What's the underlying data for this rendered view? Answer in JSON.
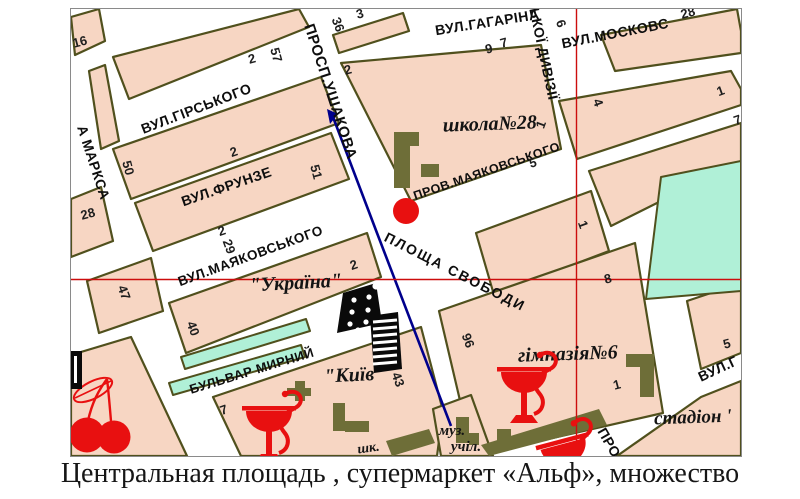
{
  "caption": "Центральная площадь , супермаркет «Альф», множество",
  "map": {
    "colors": {
      "block_fill": "#f7d6c3",
      "block_stroke": "#50501d",
      "green_fill": "#b0f0d7",
      "building_fill": "#6e6e38",
      "route_blue": "#00008c",
      "marker_red": "#e81010",
      "crosshair_red": "#cc0d0d",
      "icon_black": "#0a0a0a",
      "pharmacy_red": "#e81010"
    },
    "crosshair": {
      "x": 505.5,
      "y": 270.5
    },
    "marker": {
      "x": 335,
      "y": 202,
      "r": 13
    },
    "route": {
      "points": "262,108 306,224 380,417",
      "arrow": "256,100 267,105 259,115"
    },
    "blocks": [
      {
        "name": "block-16",
        "points": "0,8 28,0 34,32 4,46"
      },
      {
        "name": "block-topleft",
        "points": "42,48 228,0 238,18 58,90"
      },
      {
        "name": "block-marksa-sliver",
        "points": "18,62 34,56 48,132 30,140"
      },
      {
        "name": "block-28",
        "points": "0,190 30,178 42,232 0,248"
      },
      {
        "name": "block-50",
        "points": "42,140 250,68 268,114 60,190"
      },
      {
        "name": "block-51",
        "points": "64,194 260,124 278,170 82,242"
      },
      {
        "name": "block-47",
        "points": "16,272 80,249 92,302 28,324"
      },
      {
        "name": "block-ukraina",
        "points": "98,294 296,224 310,268 115,344"
      },
      {
        "name": "block-kyiv",
        "points": "142,388 350,318 372,402 366,447 170,447"
      },
      {
        "name": "block-bottomleft",
        "points": "0,346 60,328 116,447 0,447"
      },
      {
        "name": "block-shkola",
        "points": "270,54 470,36 490,140 340,192"
      },
      {
        "name": "block-36",
        "points": "262,26 332,4 338,22 268,44"
      },
      {
        "name": "block-topright-28",
        "points": "530,26 666,0 670,22 670,44 544,62"
      },
      {
        "name": "block-4",
        "points": "488,92 660,62 670,80 670,96 506,150"
      },
      {
        "name": "block-1-east",
        "points": "518,162 670,114 670,152 540,217"
      },
      {
        "name": "block-center-1",
        "points": "405,224 520,182 538,242 423,286"
      },
      {
        "name": "block-gimnasia",
        "points": "368,302 564,234 592,404 402,447"
      },
      {
        "name": "block-5",
        "points": "616,292 670,274 670,344 630,360"
      },
      {
        "name": "block-stadion",
        "points": "546,447 630,388 670,372 670,447"
      },
      {
        "name": "block-muz",
        "points": "362,400 400,386 422,447 370,447"
      }
    ],
    "green_areas": [
      {
        "name": "green-block-east",
        "points": "590,168 670,152 670,282 575,290"
      },
      {
        "name": "green-strip-1",
        "points": "110,348 235,310 239,322 114,360"
      },
      {
        "name": "green-strip-2",
        "points": "98,374 230,336 234,348 102,386"
      }
    ],
    "buildings": [
      {
        "x": 323,
        "y": 123,
        "w": 16,
        "h": 56
      },
      {
        "x": 339,
        "y": 123,
        "w": 9,
        "h": 14
      },
      {
        "x": 350,
        "y": 155,
        "w": 18,
        "h": 13
      },
      {
        "x": 555,
        "y": 345,
        "w": 28,
        "h": 13
      },
      {
        "x": 569,
        "y": 358,
        "w": 14,
        "h": 30
      },
      {
        "x": 426,
        "y": 420,
        "w": 14,
        "h": 14
      },
      {
        "x": 385,
        "y": 408,
        "w": 13,
        "h": 26
      },
      {
        "x": 398,
        "y": 424,
        "w": 10,
        "h": 12
      },
      {
        "x": 224,
        "y": 372,
        "w": 10,
        "h": 20
      },
      {
        "x": 216,
        "y": 379,
        "w": 24,
        "h": 8
      },
      {
        "x": 262,
        "y": 394,
        "w": 12,
        "h": 28
      },
      {
        "x": 274,
        "y": 412,
        "w": 24,
        "h": 11
      }
    ],
    "building_polys": [
      {
        "points": "410,436 528,400 536,416 418,447"
      },
      {
        "points": "315,432 358,420 364,434 321,447"
      }
    ],
    "street_labels": [
      {
        "text": "ПРОСП.УШАКОВА",
        "x": 255,
        "y": 84,
        "rot": 72,
        "size": 15
      },
      {
        "text": "ВУЛ.ГАГАРІНА",
        "x": 417,
        "y": 18,
        "rot": -9,
        "size": 14
      },
      {
        "text": "ВУЛ.МОСКОВС",
        "x": 545,
        "y": 29,
        "rot": -11,
        "size": 14
      },
      {
        "text": "ЬКОЇ ДИВІЗІЇ",
        "x": 468,
        "y": 46,
        "rot": 78,
        "size": 14
      },
      {
        "text": "ВУЛ.ГІРСЬКОГО",
        "x": 127,
        "y": 104,
        "rot": -21,
        "size": 14
      },
      {
        "text": "ВУЛ.ФРУНЗЕ",
        "x": 157,
        "y": 182,
        "rot": -19,
        "size": 14
      },
      {
        "text": "ВУЛ.МАЯКОВСЬКОГО",
        "x": 181,
        "y": 251,
        "rot": -20,
        "size": 13.5
      },
      {
        "text": "ПРОВ.МАЯКОВСЬКОГО",
        "x": 417,
        "y": 166,
        "rot": -19,
        "size": 12.5
      },
      {
        "text": "ПЛОЩА СВОБОДИ",
        "x": 382,
        "y": 267,
        "rot": 27,
        "size": 14,
        "ls": 2
      },
      {
        "text": "БУЛЬВАР МИРНИЙ",
        "x": 182,
        "y": 366,
        "rot": -17,
        "size": 13
      },
      {
        "text": "А МАРКСА",
        "x": 18,
        "y": 155,
        "rot": 72,
        "size": 14
      },
      {
        "text": "ВУЛ.Г",
        "x": 649,
        "y": 364,
        "rot": -25,
        "size": 14
      },
      {
        "text": "ПРО",
        "x": 534,
        "y": 436,
        "rot": 60,
        "size": 14
      }
    ],
    "place_labels": [
      {
        "text": "школа№28",
        "x": 419,
        "y": 121,
        "rot": -2,
        "size": 20
      },
      {
        "text": "гімназія№6",
        "x": 497,
        "y": 351,
        "rot": -2,
        "size": 20
      },
      {
        "text": "\"Україна\"",
        "x": 225,
        "y": 280,
        "rot": -3,
        "size": 20
      },
      {
        "text": "\"Київ\"",
        "x": 284,
        "y": 372,
        "rot": -3,
        "size": 20
      },
      {
        "text": "стадіон '",
        "x": 622,
        "y": 414,
        "rot": -2,
        "size": 19
      },
      {
        "text": "муз.",
        "x": 381,
        "y": 426,
        "rot": 0,
        "size": 15
      },
      {
        "text": "учіл.",
        "x": 395,
        "y": 442,
        "rot": 0,
        "size": 15
      },
      {
        "text": "шк.",
        "x": 298,
        "y": 443,
        "rot": -8,
        "size": 14
      }
    ],
    "numbers": [
      {
        "text": "16",
        "x": 10,
        "y": 37,
        "rot": -15
      },
      {
        "text": "2",
        "x": 182,
        "y": 54,
        "rot": -15
      },
      {
        "text": "57",
        "x": 201,
        "y": 47,
        "rot": 75
      },
      {
        "text": "36",
        "x": 263,
        "y": 17,
        "rot": 70
      },
      {
        "text": "3",
        "x": 290,
        "y": 9,
        "rot": -15
      },
      {
        "text": "2",
        "x": 278,
        "y": 65,
        "rot": -15
      },
      {
        "text": "50",
        "x": 53,
        "y": 160,
        "rot": 75
      },
      {
        "text": "2",
        "x": 164,
        "y": 147,
        "rot": -18
      },
      {
        "text": "51",
        "x": 241,
        "y": 164,
        "rot": 75
      },
      {
        "text": "28",
        "x": 18,
        "y": 209,
        "rot": -15
      },
      {
        "text": "2",
        "x": 152,
        "y": 226,
        "rot": -18
      },
      {
        "text": "29",
        "x": 154,
        "y": 239,
        "rot": 70
      },
      {
        "text": "47",
        "x": 49,
        "y": 285,
        "rot": 70
      },
      {
        "text": "40",
        "x": 118,
        "y": 321,
        "rot": 70
      },
      {
        "text": "2",
        "x": 284,
        "y": 260,
        "rot": -18
      },
      {
        "text": "43",
        "x": 323,
        "y": 372,
        "rot": 70
      },
      {
        "text": "7",
        "x": 154,
        "y": 405,
        "rot": -18
      },
      {
        "text": "9",
        "x": 419,
        "y": 44,
        "rot": -15
      },
      {
        "text": "7",
        "x": 434,
        "y": 38,
        "rot": -15
      },
      {
        "text": "6",
        "x": 486,
        "y": 16,
        "rot": 70
      },
      {
        "text": "4",
        "x": 523,
        "y": 95,
        "rot": 70
      },
      {
        "text": "28",
        "x": 618,
        "y": 8,
        "rot": -15
      },
      {
        "text": "1",
        "x": 651,
        "y": 86,
        "rot": -20
      },
      {
        "text": "7",
        "x": 668,
        "y": 115,
        "rot": -20
      },
      {
        "text": "1",
        "x": 474,
        "y": 117,
        "rot": -70
      },
      {
        "text": "5",
        "x": 463,
        "y": 158,
        "rot": -15
      },
      {
        "text": "1",
        "x": 508,
        "y": 217,
        "rot": 70
      },
      {
        "text": "8",
        "x": 538,
        "y": 274,
        "rot": -15
      },
      {
        "text": "96",
        "x": 393,
        "y": 333,
        "rot": 70
      },
      {
        "text": "1",
        "x": 547,
        "y": 380,
        "rot": -15
      },
      {
        "text": "5",
        "x": 657,
        "y": 339,
        "rot": -15
      }
    ],
    "icons": [
      {
        "type": "pharmacy-icon",
        "x": 198,
        "y": 399,
        "rot": 0
      },
      {
        "type": "pharmacy-icon",
        "x": 453,
        "y": 360,
        "rot": 0
      },
      {
        "type": "pharmacy-icon",
        "x": 491,
        "y": 432,
        "rot": -15
      },
      {
        "type": "cherry-icon",
        "x": 0,
        "y": 0
      },
      {
        "type": "cinema-icon",
        "x": 0,
        "y": 0
      },
      {
        "type": "striped-building-icon",
        "x": 0,
        "y": 0
      },
      {
        "type": "black-edge-icon",
        "x": 0,
        "y": 0
      }
    ]
  }
}
